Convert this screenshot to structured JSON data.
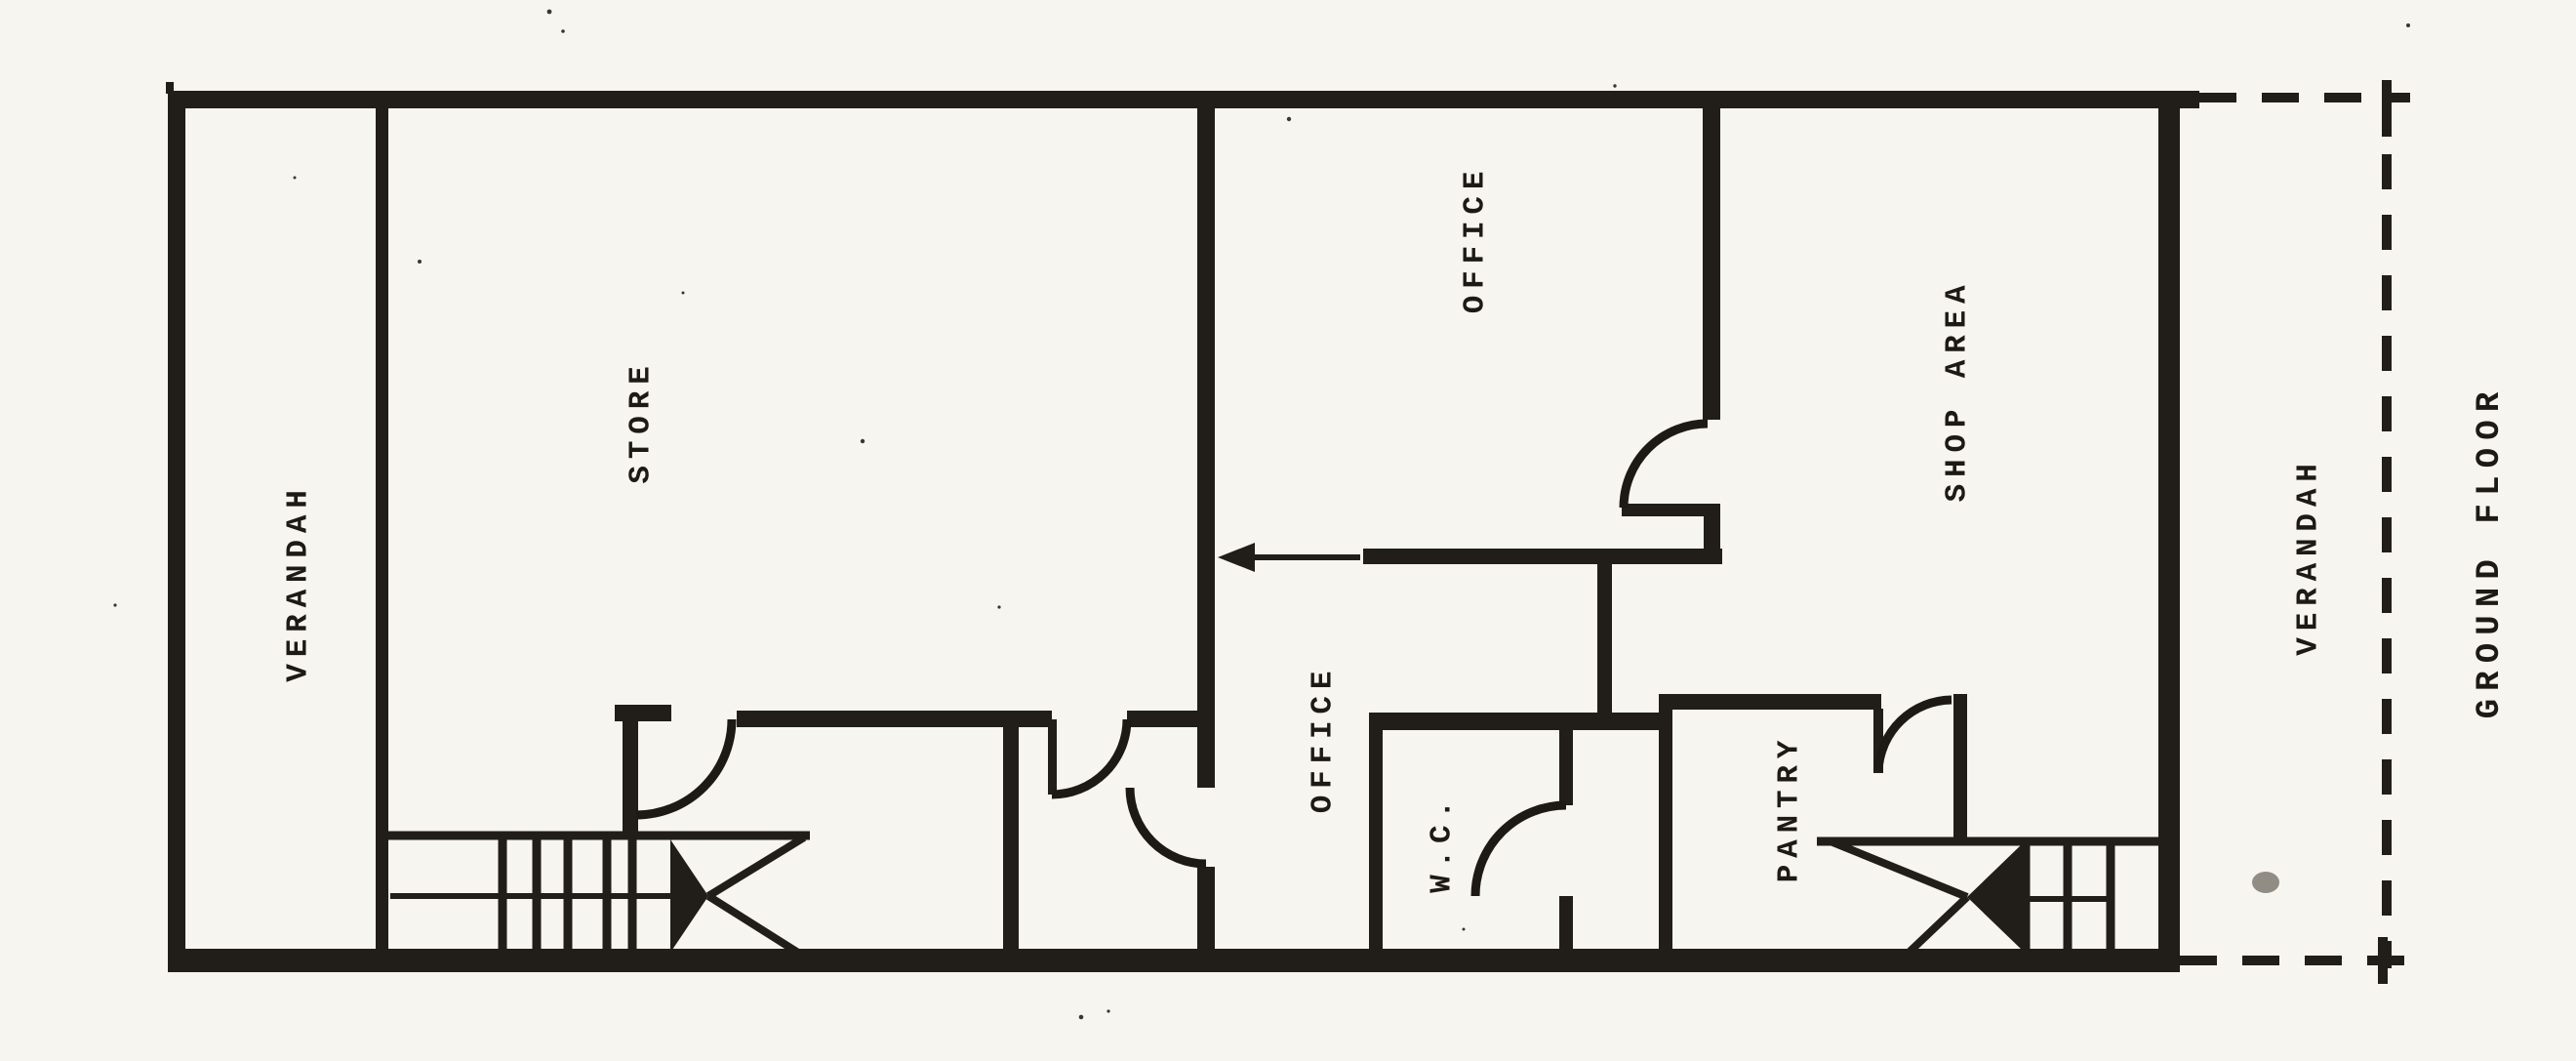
{
  "drawing_title": "GROUND FLOOR",
  "rooms": [
    {
      "id": "verandah-left",
      "label": "VERANDAH"
    },
    {
      "id": "store",
      "label": "STORE"
    },
    {
      "id": "office-upper",
      "label": "OFFICE"
    },
    {
      "id": "shop-area",
      "label": "SHOP AREA"
    },
    {
      "id": "office-lower",
      "label": "OFFICE"
    },
    {
      "id": "wc",
      "label": "W.C."
    },
    {
      "id": "pantry",
      "label": "PANTRY"
    },
    {
      "id": "verandah-right",
      "label": "VERANDAH"
    }
  ],
  "caption": "GROUND FLOOR",
  "symbols": {
    "dashed_line_meaning": "verandah open boundary",
    "arrow_meaning": "entry direction arrow",
    "stair_runs": 2
  },
  "colors": {
    "ink": "#211e19",
    "paper": "#f7f5ef"
  }
}
